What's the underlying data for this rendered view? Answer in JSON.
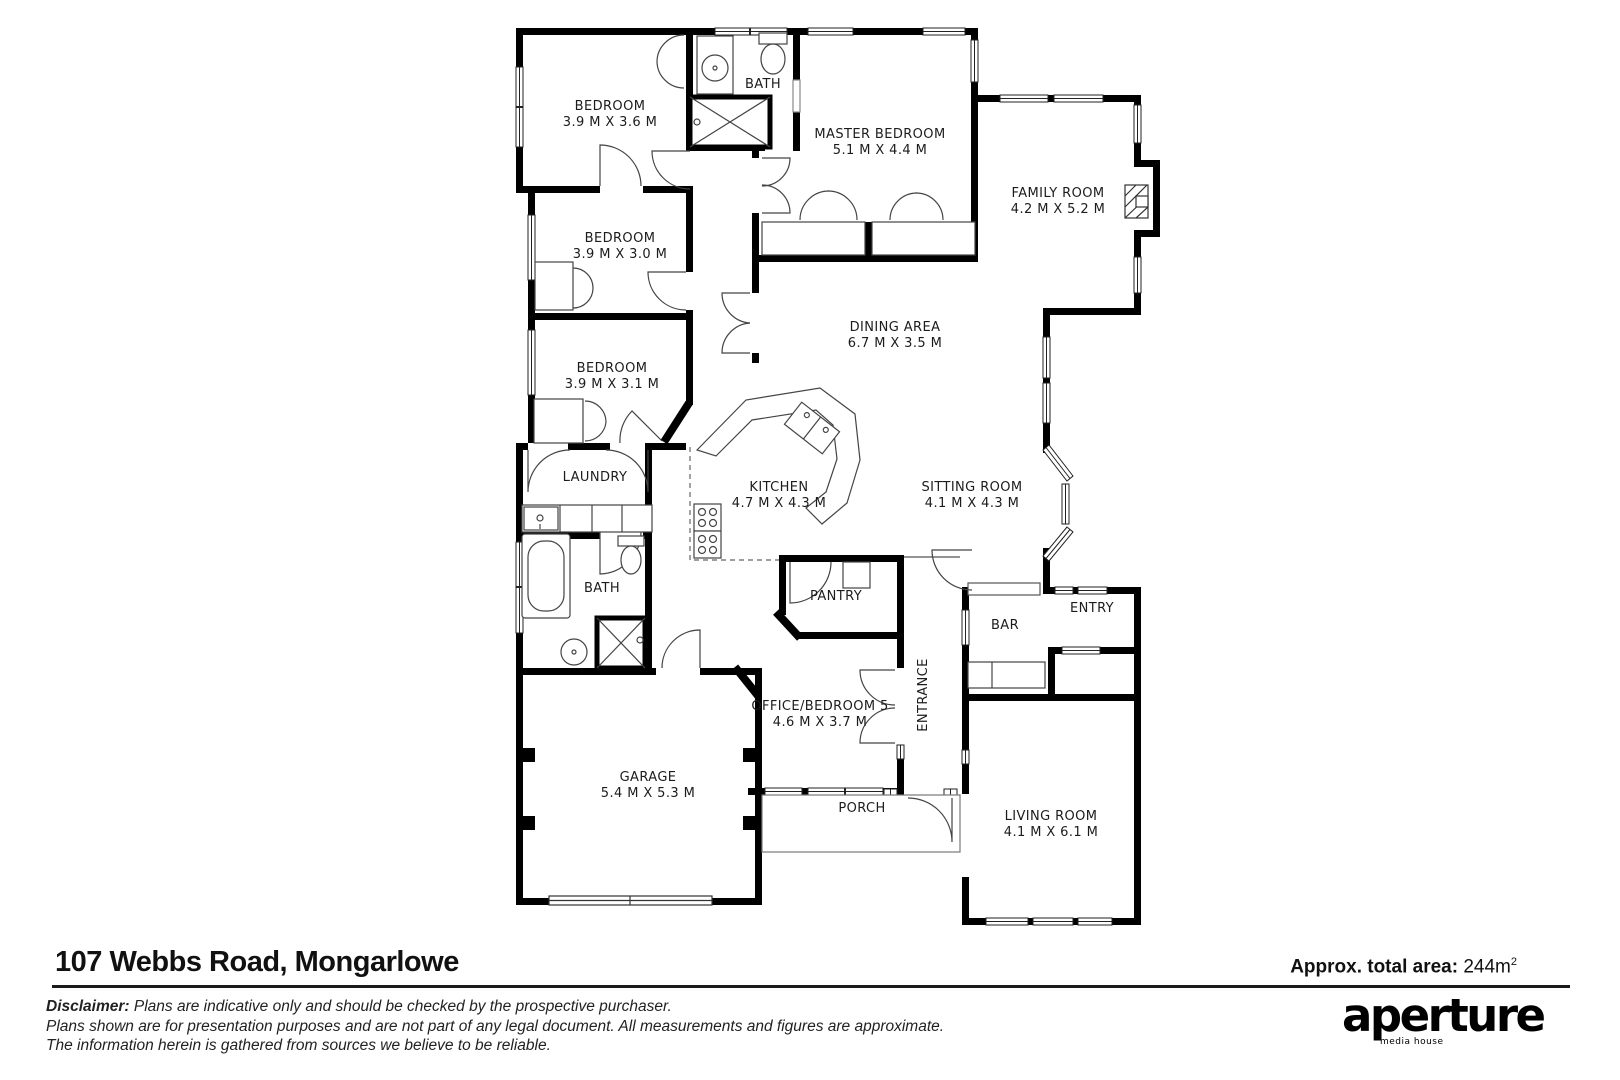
{
  "footer": {
    "address": "107 Webbs Road, Mongarlowe",
    "total_area": {
      "label": "Approx. total area:",
      "value": "244m",
      "sup": "2"
    },
    "disclaimer": {
      "label": "Disclaimer:",
      "line1": "Plans are indicative only and should be checked by the prospective purchaser.",
      "line2": "Plans shown are for presentation purposes and are not part of any legal document. All measurements and figures are approximate.",
      "line3": "The information herein is gathered from sources we believe to be reliable."
    },
    "logo": {
      "name": "aperture",
      "tagline": "media house"
    }
  },
  "colors": {
    "wall": "#000000",
    "thin_line": "#444444",
    "background": "#ffffff"
  },
  "rooms": {
    "bedroom1": {
      "label": "BEDROOM",
      "dims": "3.9 M X 3.6 M"
    },
    "bedroom2": {
      "label": "BEDROOM",
      "dims": "3.9 M X 3.0 M"
    },
    "bedroom3": {
      "label": "BEDROOM",
      "dims": "3.9 M X 3.1 M"
    },
    "bath_top": {
      "label": "BATH"
    },
    "bath_lower": {
      "label": "BATH"
    },
    "master": {
      "label": "MASTER BEDROOM",
      "dims": "5.1 M X 4.4 M"
    },
    "family": {
      "label": "FAMILY ROOM",
      "dims": "4.2 M X 5.2 M"
    },
    "dining": {
      "label": "DINING AREA",
      "dims": "6.7 M X 3.5 M"
    },
    "kitchen": {
      "label": "KITCHEN",
      "dims": "4.7 M X 4.3 M"
    },
    "sitting": {
      "label": "SITTING ROOM",
      "dims": "4.1 M X 4.3 M"
    },
    "laundry": {
      "label": "LAUNDRY"
    },
    "pantry": {
      "label": "PANTRY"
    },
    "office": {
      "label": "OFFICE/BEDROOM 5",
      "dims": "4.6 M X 3.7 M"
    },
    "entrance": {
      "label": "ENTRANCE"
    },
    "bar": {
      "label": "BAR"
    },
    "entry": {
      "label": "ENTRY"
    },
    "garage": {
      "label": "GARAGE",
      "dims": "5.4 M X 5.3 M"
    },
    "porch": {
      "label": "PORCH"
    },
    "living": {
      "label": "LIVING ROOM",
      "dims": "4.1 M X 6.1 M"
    }
  }
}
